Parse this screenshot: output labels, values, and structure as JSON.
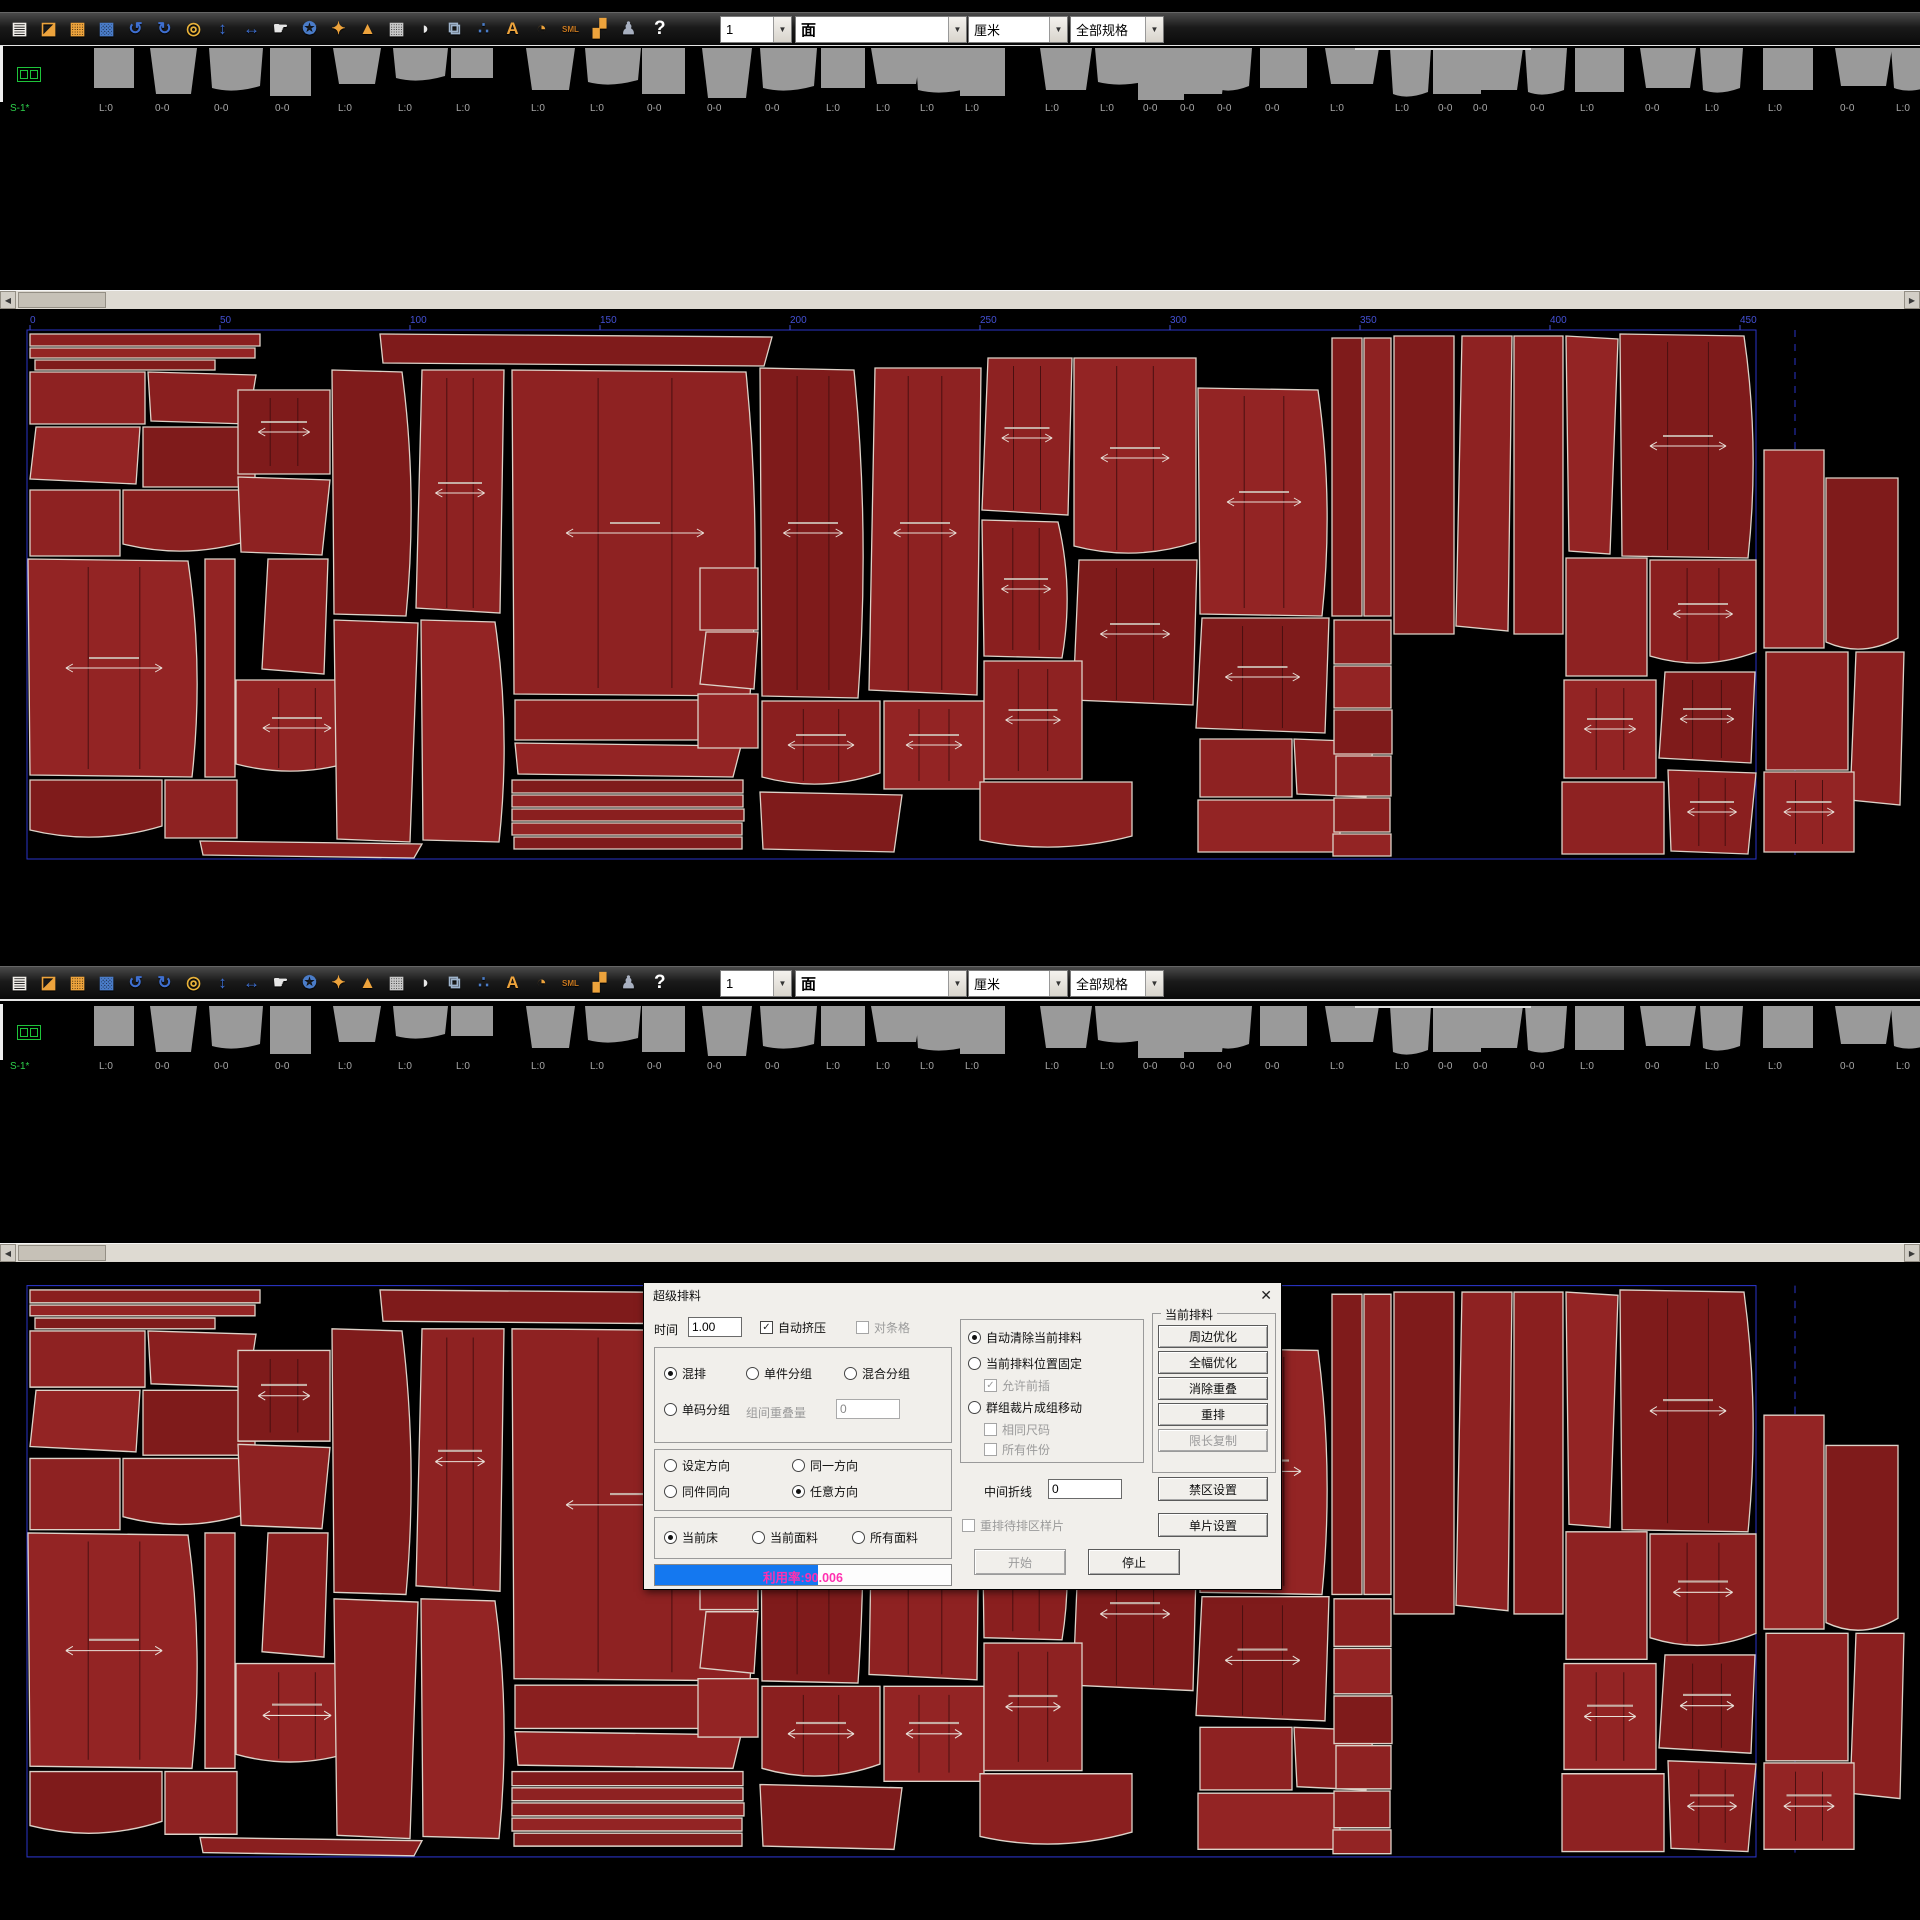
{
  "toolbar": {
    "help_label": "?",
    "icons": [
      {
        "name": "new-document-icon",
        "glyph": "▤",
        "color": "#f0ede8"
      },
      {
        "name": "open-folder-icon",
        "glyph": "◪",
        "color": "#eda33c"
      },
      {
        "name": "save-icon",
        "glyph": "▦",
        "color": "#eda33c"
      },
      {
        "name": "save-as-icon",
        "glyph": "▩",
        "color": "#4a7cc8"
      },
      {
        "name": "undo-icon",
        "glyph": "↺",
        "color": "#3e6fd0"
      },
      {
        "name": "redo-icon",
        "glyph": "↻",
        "color": "#3e6fd0"
      },
      {
        "name": "zoom-icon",
        "glyph": "◎",
        "color": "#e8b23a"
      },
      {
        "name": "fit-vertical-icon",
        "glyph": "↕",
        "color": "#3e6fd0"
      },
      {
        "name": "fit-horizontal-icon",
        "glyph": "↔",
        "color": "#3e6fd0"
      },
      {
        "name": "hand-icon",
        "glyph": "☛",
        "color": "#e5e5e5"
      },
      {
        "name": "reel-icon",
        "glyph": "✪",
        "color": "#4a7cc8"
      },
      {
        "name": "nest-icon",
        "glyph": "✦",
        "color": "#eda33c"
      },
      {
        "name": "export-icon",
        "glyph": "▲",
        "color": "#eda33c"
      },
      {
        "name": "marker-icon",
        "glyph": "▦",
        "color": "#c8c8c8"
      },
      {
        "name": "ink-icon",
        "glyph": "◗",
        "color": "#e8e8e8"
      },
      {
        "name": "copy-icon",
        "glyph": "⧉",
        "color": "#9fb4cc"
      },
      {
        "name": "share-icon",
        "glyph": "∴",
        "color": "#4a7cc8"
      },
      {
        "name": "text-icon",
        "glyph": "A",
        "color": "#eda33c"
      },
      {
        "name": "pie-chart-icon",
        "glyph": "◔",
        "color": "#eda33c"
      },
      {
        "name": "sml-sizes-icon",
        "glyph": "SML",
        "color": "#c87820"
      },
      {
        "name": "group-icon",
        "glyph": "▞",
        "color": "#eda33c"
      },
      {
        "name": "user-icon",
        "glyph": "♟",
        "color": "#a8b0c0"
      }
    ],
    "combos": [
      {
        "value": "1"
      },
      {
        "value": "面"
      },
      {
        "value": "厘米"
      },
      {
        "value": "全部规格"
      }
    ]
  },
  "strip": {
    "sheet_label": "S-1*",
    "labels": [
      "L:0",
      "0-0",
      "0-0",
      "0-0",
      "L:0",
      "L:0",
      "L:0",
      "L:0",
      "L:0",
      "0-0",
      "0-0",
      "0-0",
      "L:0",
      "L:0",
      "L:0",
      "L:0",
      "L:0",
      "L:0",
      "0-0",
      "0-0",
      "0-0",
      "0-0",
      "L:0",
      "L:0",
      "0-0",
      "0-0",
      "0-0",
      "L:0",
      "0-0",
      "L:0",
      "L:0",
      "0-0",
      "L:0"
    ]
  },
  "ruler": {
    "ticks": [
      "0",
      "50",
      "100",
      "150",
      "200",
      "250",
      "300",
      "350",
      "400",
      "450"
    ]
  },
  "scrollbar": {
    "left_arrow": "◀",
    "right_arrow": "▶"
  },
  "dialog": {
    "title": "超级排料",
    "close": "✕",
    "time_label": "时间",
    "time_value": "1.00",
    "auto_squeeze": "自动挤压",
    "stripe_match": "对条格",
    "mix": "混排",
    "single_group": "单件分组",
    "mixed_group": "混合分组",
    "single_size_group": "单码分组",
    "overlap_label": "组间重叠量",
    "overlap_value": "0",
    "set_dir": "设定方向",
    "same_dir": "同一方向",
    "same_piece_dir": "同件同向",
    "any_dir": "任意方向",
    "current_bed": "当前床",
    "current_fabric": "当前面料",
    "all_fabrics": "所有面料",
    "auto_clear": "自动清除当前排料",
    "fixed_pos": "当前排料位置固定",
    "allow_insert": "允许前插",
    "group_move": "群组裁片成组移动",
    "same_size": "相同尺码",
    "all_pieces": "所有件份",
    "fold_label": "中间折线",
    "fold_value": "0",
    "rearrange": "重排待排区样片",
    "panel_title": "当前排料",
    "edge_opt": "周边优化",
    "full_opt": "全幅优化",
    "remove_overlap": "消除重叠",
    "renest": "重排",
    "limit_copy": "限长复制",
    "forbid_zone": "禁区设置",
    "piece_setting": "单片设置",
    "start": "开始",
    "stop": "停止",
    "utilization": "利用率:90.006",
    "progress_pct": 55
  }
}
